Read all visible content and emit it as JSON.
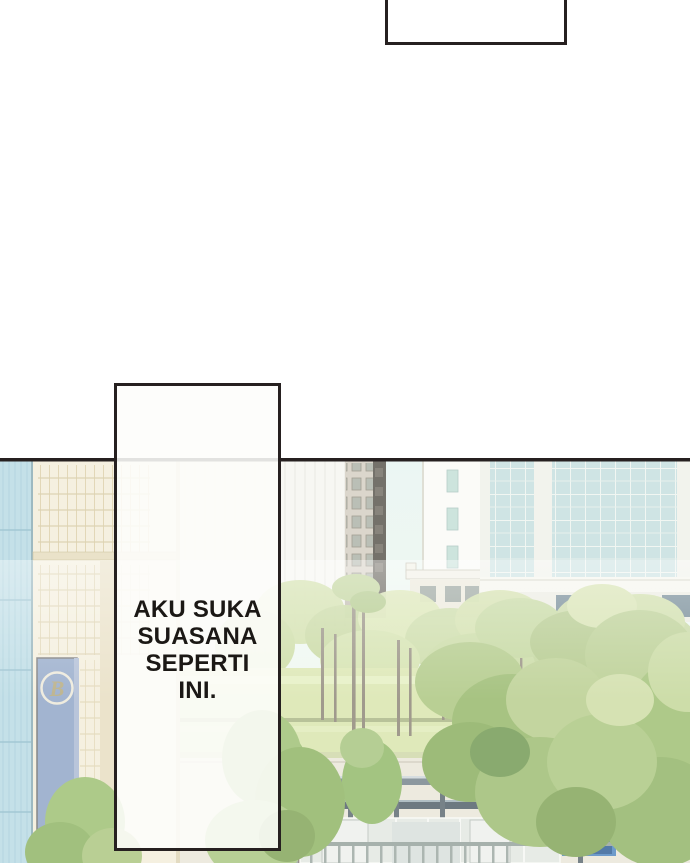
{
  "page": {
    "type_label": "comic page",
    "background_color": "#ffffff",
    "ink_color": "#262020"
  },
  "top_bubble": {
    "text": ""
  },
  "dialogue": {
    "full_text": "AKU SUKA SUASANA SEPERTI INI.",
    "lines": [
      "AKU SUKA",
      "SUASANA",
      "SEPERTI",
      "INI."
    ]
  },
  "city": {
    "logo_letter": "B",
    "colors": {
      "sky": "#e7f5f1",
      "glass_building_left": "#b7d9e3",
      "beige_building": "#f3edda",
      "banner_blue": "#8ea4c6",
      "logo_gold": "#b0a578",
      "tower_gray": "#d3cec1",
      "curtain_wall_glass": "#c5dfde",
      "lawn_green": "#d8e5ab",
      "foliage_mid": "#9dbf72",
      "foliage_dark": "#7fa355",
      "foliage_light": "#c8da9c",
      "shelter_steel": "#5a676e",
      "bus_blue": "#66a3d6",
      "signal_green": "#82c24f"
    }
  }
}
